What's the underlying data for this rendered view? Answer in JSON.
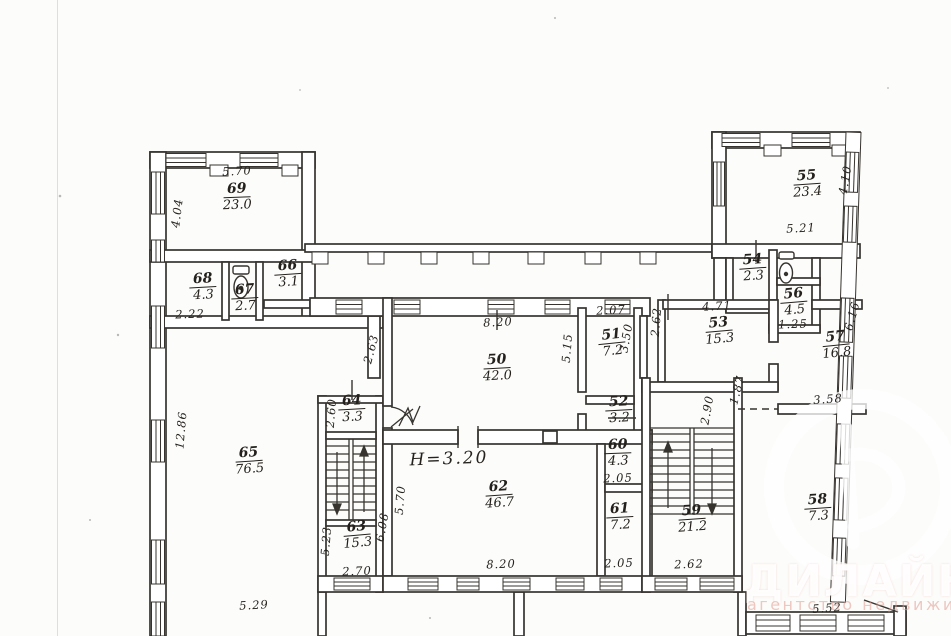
{
  "watermark": {
    "brand": "ДИЛАЙН",
    "tagline": "агентство недвижимости",
    "logo": "dilain-circle-d-logo",
    "brand_color": "#ffffff",
    "tagline_color": "#e09a90"
  },
  "plan": {
    "height_note": "H=3.20",
    "ink_color": "#37342f",
    "icons": [
      "toilet-icon",
      "toilet-icon",
      "stair-up-arrow",
      "stair-down-arrow",
      "door-swing-icon"
    ],
    "rooms": [
      {
        "number": "69",
        "area": "23.0",
        "x": 237,
        "y": 196,
        "rot": -2
      },
      {
        "number": "68",
        "area": "4.3",
        "x": 203,
        "y": 286,
        "rot": -3
      },
      {
        "number": "67",
        "area": "2.7",
        "x": 245,
        "y": 297,
        "rot": -3
      },
      {
        "number": "66",
        "area": "3.1",
        "x": 288,
        "y": 273,
        "rot": -4
      },
      {
        "number": "65",
        "area": "76.5",
        "x": 249,
        "y": 460,
        "rot": -4
      },
      {
        "number": "64",
        "area": "3.3",
        "x": 352,
        "y": 408,
        "rot": -3
      },
      {
        "number": "63",
        "area": "15.3",
        "x": 357,
        "y": 534,
        "rot": -5
      },
      {
        "number": "50",
        "area": "42.0",
        "x": 497,
        "y": 367,
        "rot": -3
      },
      {
        "number": "51",
        "area": "7.2",
        "x": 612,
        "y": 342,
        "rot": -6
      },
      {
        "number": "52",
        "area": "3.2",
        "x": 619,
        "y": 409,
        "rot": -3
      },
      {
        "number": "62",
        "area": "46.7",
        "x": 499,
        "y": 494,
        "rot": -4
      },
      {
        "number": "60",
        "area": "4.3",
        "x": 618,
        "y": 452,
        "rot": -2
      },
      {
        "number": "61",
        "area": "7.2",
        "x": 620,
        "y": 516,
        "rot": -3
      },
      {
        "number": "59",
        "area": "21.2",
        "x": 692,
        "y": 518,
        "rot": -4
      },
      {
        "number": "58",
        "area": "7.3",
        "x": 818,
        "y": 507,
        "rot": -4
      },
      {
        "number": "57",
        "area": "16.8",
        "x": 836,
        "y": 344,
        "rot": -6
      },
      {
        "number": "56",
        "area": "4.5",
        "x": 794,
        "y": 301,
        "rot": -5
      },
      {
        "number": "54",
        "area": "2.3",
        "x": 753,
        "y": 267,
        "rot": -4
      },
      {
        "number": "55",
        "area": "23.4",
        "x": 807,
        "y": 183,
        "rot": -4
      },
      {
        "number": "53",
        "area": "15.3",
        "x": 719,
        "y": 330,
        "rot": -5
      }
    ],
    "dimensions": [
      {
        "text": "5.70",
        "x": 237,
        "y": 171,
        "rot": -3
      },
      {
        "text": "4.04",
        "x": 177,
        "y": 213,
        "rot": -83
      },
      {
        "text": "2.22",
        "x": 190,
        "y": 314,
        "rot": -2
      },
      {
        "text": "12.86",
        "x": 181,
        "y": 430,
        "rot": -85
      },
      {
        "text": "5.29",
        "x": 254,
        "y": 605,
        "rot": -3
      },
      {
        "text": "2.63",
        "x": 371,
        "y": 349,
        "rot": -75
      },
      {
        "text": "2.60",
        "x": 331,
        "y": 413,
        "rot": -85
      },
      {
        "text": "5.23",
        "x": 326,
        "y": 541,
        "rot": -85
      },
      {
        "text": "6.08",
        "x": 382,
        "y": 527,
        "rot": -80
      },
      {
        "text": "2.70",
        "x": 357,
        "y": 571,
        "rot": -2
      },
      {
        "text": "5.70",
        "x": 400,
        "y": 500,
        "rot": -85
      },
      {
        "text": "8.20",
        "x": 498,
        "y": 322,
        "rot": -3
      },
      {
        "text": "5.15",
        "x": 567,
        "y": 348,
        "rot": -85
      },
      {
        "text": "2.07",
        "x": 611,
        "y": 310,
        "rot": -3
      },
      {
        "text": "3.50",
        "x": 626,
        "y": 338,
        "rot": -80
      },
      {
        "text": "8.20",
        "x": 501,
        "y": 564,
        "rot": -2
      },
      {
        "text": "2.05",
        "x": 618,
        "y": 478,
        "rot": -2
      },
      {
        "text": "2.05",
        "x": 619,
        "y": 563,
        "rot": -2
      },
      {
        "text": "2.90",
        "x": 707,
        "y": 410,
        "rot": -80
      },
      {
        "text": "1.87",
        "x": 737,
        "y": 390,
        "rot": -75
      },
      {
        "text": "2.62",
        "x": 689,
        "y": 564,
        "rot": -2
      },
      {
        "text": "2.62",
        "x": 656,
        "y": 322,
        "rot": -85
      },
      {
        "text": "4.71",
        "x": 717,
        "y": 306,
        "rot": -3
      },
      {
        "text": "1.25",
        "x": 793,
        "y": 324,
        "rot": -2
      },
      {
        "text": "3.58",
        "x": 828,
        "y": 399,
        "rot": -4
      },
      {
        "text": "5.21",
        "x": 801,
        "y": 228,
        "rot": -3
      },
      {
        "text": "4.10",
        "x": 845,
        "y": 180,
        "rot": -80
      },
      {
        "text": "6.16",
        "x": 852,
        "y": 316,
        "rot": -75
      },
      {
        "text": "5.52",
        "x": 827,
        "y": 608,
        "rot": -4
      },
      {
        "text": "H=3.20",
        "x": 449,
        "y": 459,
        "rot": -2,
        "big": true
      }
    ]
  }
}
